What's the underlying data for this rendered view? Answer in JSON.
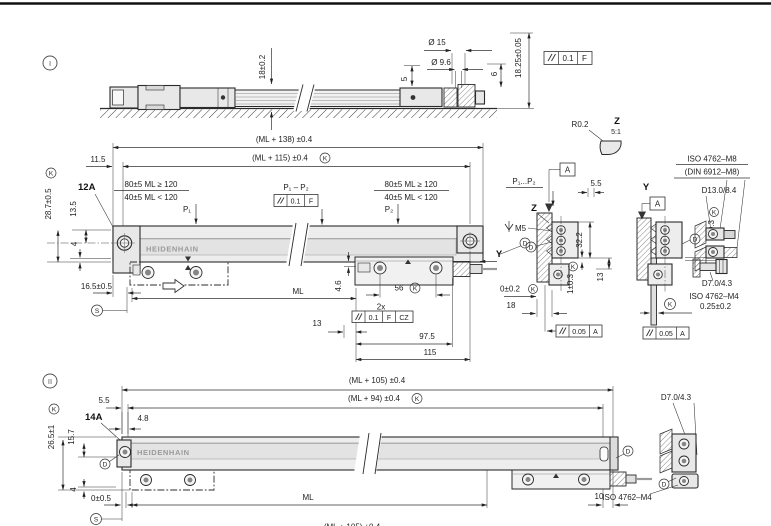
{
  "colors": {
    "line": "#2b2b2b",
    "fill_light": "#ededed",
    "band": "#e3e3e3",
    "logo_text": "#9a9a9a"
  },
  "sym": {
    "k": "K",
    "s": "S",
    "d": "D",
    "a": "A"
  },
  "view1": {
    "marker": "I",
    "elev": {
      "h18": "18±0.2",
      "dia15": "Ø 15",
      "dia96": "Ø 9.6",
      "d5": "5",
      "d6": "6",
      "d1825": "18.25±0.05",
      "fcf": {
        "value": "0.1",
        "datum": "F"
      },
      "detail": {
        "r": "R0.2",
        "label": "Z",
        "scale": "5:1"
      }
    },
    "plan": {
      "ml138": "(ML + 138) ±0.4",
      "ml115": "(ML + 115) ±0.4",
      "d115": "11.5",
      "ref12a": "12A",
      "clampA1": "80±5 ML ≥ 120",
      "clampA2": "40±5 ML < 120",
      "clampB1": "80±5 ML ≥ 120",
      "clampB2": "40±5 ML < 120",
      "p1": "P₁",
      "p2": "P₂",
      "p1p2": "P₁ – P₂",
      "fcf_p": {
        "value": "0.1",
        "datum": "F"
      },
      "d287": "28.7±0.5",
      "d135": "13.5",
      "d4": "4",
      "d165": "16.5±0.5",
      "logo": "HEIDENHAIN",
      "ml": "ML",
      "d46": "4.6",
      "d56": "56",
      "x2": "2x",
      "fcf_cz": {
        "value": "0.1",
        "datum": "F",
        "zone": "CZ"
      },
      "d13": "13",
      "d975": "97.5",
      "d115b": "115",
      "y": "Y",
      "d002": "0±0.2",
      "d18": "18"
    }
  },
  "sections": {
    "p1p2": "P₁...P₂",
    "d55": "5.5",
    "z": {
      "label": "Z",
      "m5": "M5",
      "d322": "32.2",
      "d103": "1±0.3",
      "d13": "13",
      "fcf": {
        "value": "0.05",
        "datum": "A"
      }
    },
    "y": {
      "label": "Y",
      "d103": "1±0.3",
      "d025": "0.25±0.2",
      "fcf": {
        "value": "0.05",
        "datum": "A"
      }
    },
    "screws": {
      "iso_m8": "ISO 4762–M8",
      "din_m8": "(DIN 6912–M8)",
      "d1384": "D13.0/8.4",
      "d7043": "D7.0/4.3",
      "iso_m4": "ISO 4762–M4"
    }
  },
  "view2": {
    "marker": "II",
    "ml105": "(ML + 105) ±0.4",
    "ml94": "(ML + 94) ±0.4",
    "d55": "5.5",
    "d265": "26.5±1",
    "d157": "15.7",
    "ref14a": "14A",
    "d48": "4.8",
    "logo": "HEIDENHAIN",
    "d4": "4",
    "d005": "0±0.5",
    "ml": "ML",
    "d10": "10",
    "screws": {
      "d7043": "D7.0/4.3",
      "iso_m4": "ISO 4762–M4"
    },
    "bottom": "(ML + 105) ±0.4"
  }
}
